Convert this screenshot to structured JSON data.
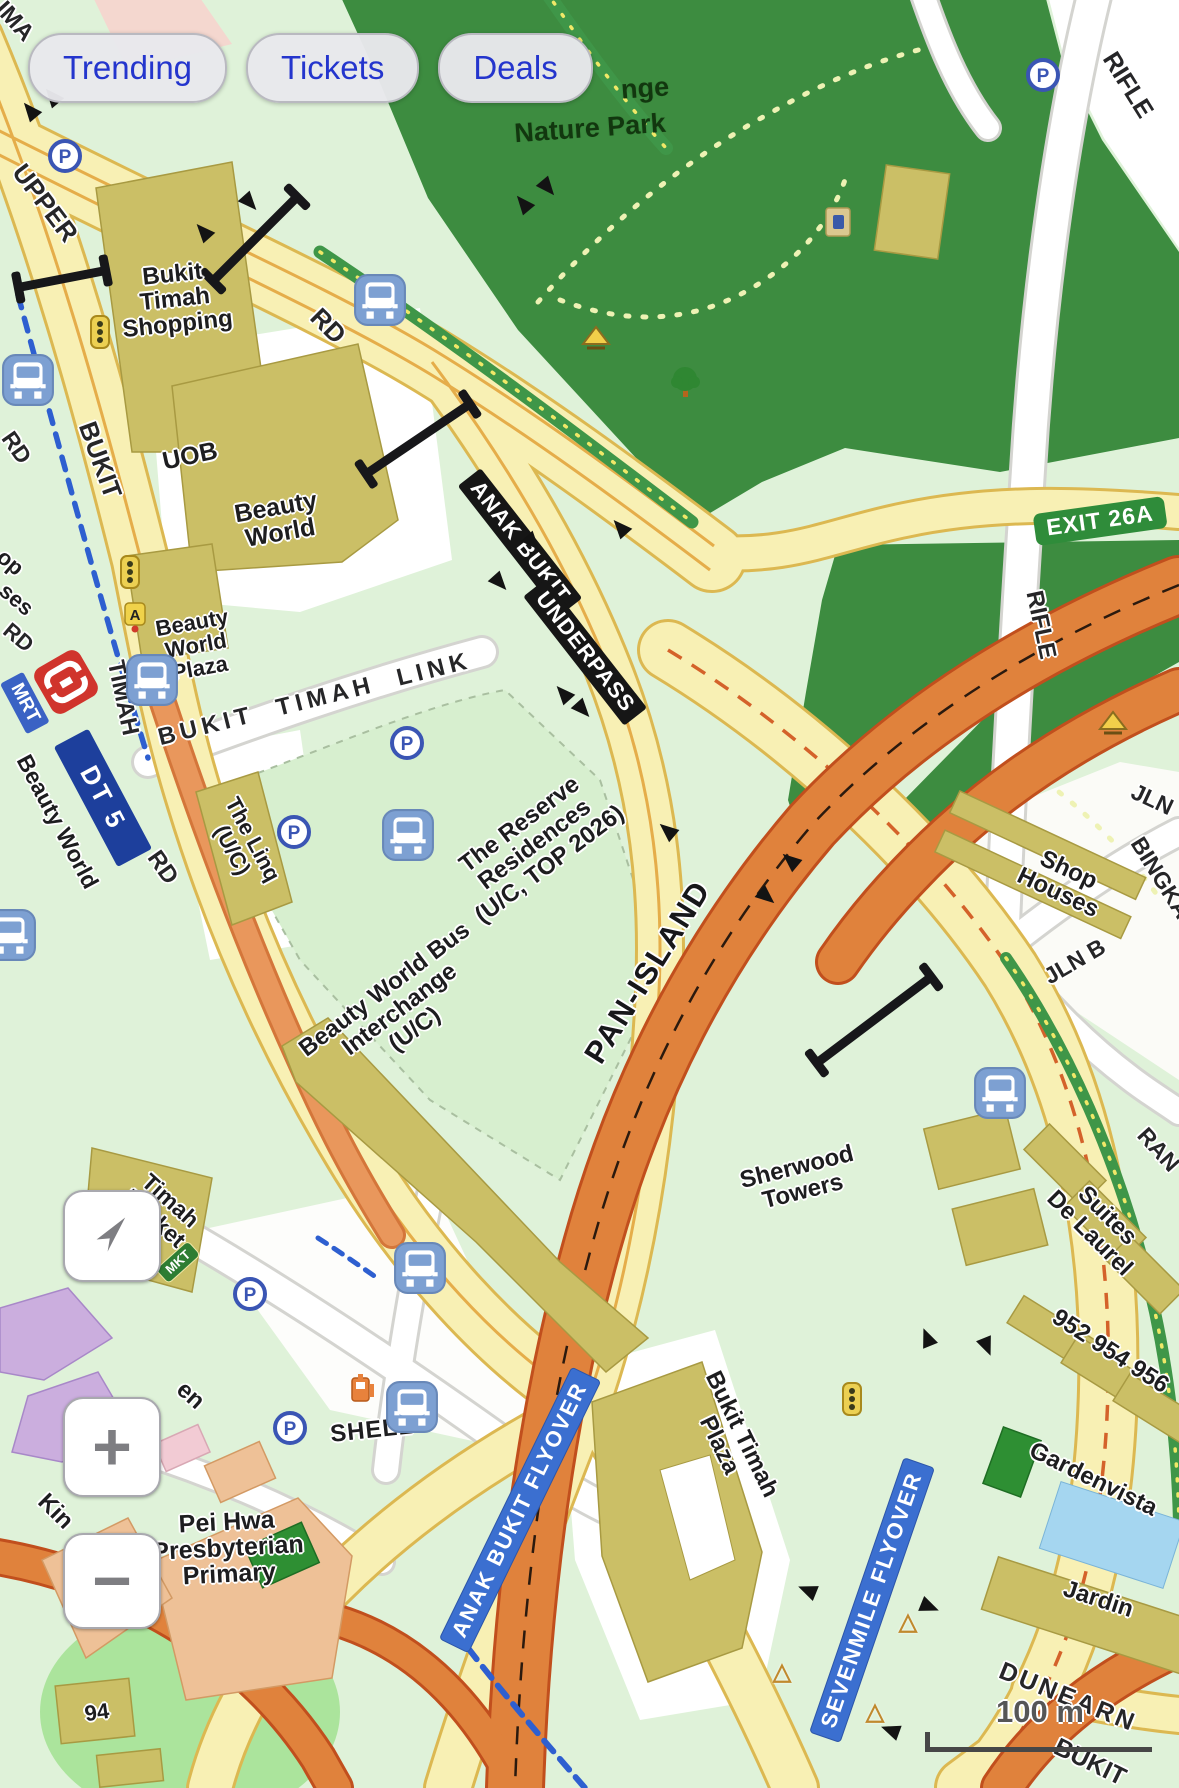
{
  "chips": {
    "items": [
      {
        "label": "Trending"
      },
      {
        "label": "Tickets"
      },
      {
        "label": "Deals"
      }
    ]
  },
  "controls": {
    "zoom_in_label": "+",
    "zoom_out_label": "−"
  },
  "scale_bar": {
    "label": "100 m"
  },
  "mrt": {
    "badge": "MRT",
    "code": "DT 5",
    "station": "Beauty World"
  },
  "colors": {
    "accent_blue": "#2435cd",
    "park_green": "#3d8c40",
    "expressway_orange": "#e0823c",
    "road_yellow": "#f8f0b4",
    "building_olive": "#cbbf66",
    "flyover_badge": "#3b6fd0",
    "mrt_navy": "#1d3f9c",
    "mrt_red": "#d0342c"
  },
  "map": {
    "labels": [
      {
        "t": "IMA",
        "x": 14,
        "y": 22,
        "r": 48,
        "c": "road",
        "s": 24
      },
      {
        "t": "UPPER",
        "x": 45,
        "y": 203,
        "r": 53,
        "c": "road",
        "s": 26
      },
      {
        "t": "BUKIT",
        "x": 100,
        "y": 460,
        "r": 70,
        "c": "road",
        "s": 26
      },
      {
        "t": "RD",
        "x": 16,
        "y": 448,
        "r": 55,
        "c": "road",
        "s": 23
      },
      {
        "t": "op",
        "x": 10,
        "y": 563,
        "r": 40,
        "c": "building",
        "s": 22
      },
      {
        "t": "ses",
        "x": 16,
        "y": 600,
        "r": 40,
        "c": "building",
        "s": 22
      },
      {
        "t": "RD",
        "x": 18,
        "y": 638,
        "r": 40,
        "c": "road",
        "s": 22
      },
      {
        "t": "TIMAH",
        "x": 122,
        "y": 698,
        "r": 78,
        "c": "road",
        "s": 24
      },
      {
        "t": "RD",
        "x": 162,
        "y": 868,
        "r": 55,
        "c": "road",
        "s": 24
      },
      {
        "t": "RD",
        "x": 328,
        "y": 326,
        "r": 45,
        "c": "road",
        "s": 26
      },
      {
        "t": "BUKIT  TIMAH  LINK",
        "x": 315,
        "y": 700,
        "r": -14,
        "c": "road",
        "s": 24,
        "ls": 5
      },
      {
        "t": "Bukit\nTimah\nShopping",
        "x": 175,
        "y": 300,
        "r": -6,
        "c": "building",
        "s": 24
      },
      {
        "t": "UOB",
        "x": 190,
        "y": 456,
        "r": -12,
        "c": "building",
        "s": 25
      },
      {
        "t": "Beauty\nWorld",
        "x": 278,
        "y": 520,
        "r": -10,
        "c": "building",
        "s": 25
      },
      {
        "t": "Beauty\nWorld\nPlaza",
        "x": 196,
        "y": 646,
        "r": -10,
        "c": "building",
        "s": 22
      },
      {
        "t": "The Linq\n(U/C)",
        "x": 242,
        "y": 845,
        "r": 62,
        "c": "building",
        "s": 22
      },
      {
        "t": "ANAK BUKIT",
        "x": 520,
        "y": 542,
        "r": 52,
        "c": "badge-black",
        "s": 22
      },
      {
        "t": "UNDERPASS",
        "x": 585,
        "y": 652,
        "r": 52,
        "c": "badge-black",
        "s": 22
      },
      {
        "t": "nge",
        "x": 645,
        "y": 88,
        "r": -4,
        "c": "park",
        "s": 27
      },
      {
        "t": "Nature Park",
        "x": 590,
        "y": 128,
        "r": -4,
        "c": "park",
        "s": 27
      },
      {
        "t": "RIFLE",
        "x": 1128,
        "y": 85,
        "r": 58,
        "c": "road",
        "s": 25
      },
      {
        "t": "EXIT 26A",
        "x": 1100,
        "y": 521,
        "r": -8,
        "c": "badge-green",
        "s": 23
      },
      {
        "t": "RIFLE",
        "x": 1040,
        "y": 625,
        "r": 78,
        "c": "road",
        "s": 24
      },
      {
        "t": "JLN",
        "x": 1152,
        "y": 800,
        "r": 25,
        "c": "road",
        "s": 23
      },
      {
        "t": "BINGKA",
        "x": 1160,
        "y": 878,
        "r": 58,
        "c": "road",
        "s": 23
      },
      {
        "t": "Shop\nHouses",
        "x": 1063,
        "y": 882,
        "r": 25,
        "c": "building",
        "s": 24
      },
      {
        "t": "JLN B",
        "x": 1075,
        "y": 962,
        "r": -30,
        "c": "road",
        "s": 23
      },
      {
        "t": "The Reserve\nResidences\n(U/C, TOP 2026)",
        "x": 535,
        "y": 845,
        "r": -37,
        "c": "building",
        "s": 24
      },
      {
        "t": "Beauty World Bus\nInterchange\n(U/C)",
        "x": 400,
        "y": 1010,
        "r": -37,
        "c": "building",
        "s": 24
      },
      {
        "t": "PAN-ISLAND",
        "x": 648,
        "y": 972,
        "r": -58,
        "c": "road-big",
        "s": 31
      },
      {
        "t": "RAN",
        "x": 1158,
        "y": 1150,
        "r": 48,
        "c": "road",
        "s": 23
      },
      {
        "t": "Sherwood\nTowers",
        "x": 800,
        "y": 1180,
        "r": -14,
        "c": "building",
        "s": 24
      },
      {
        "t": "Suites\nDe Laurel",
        "x": 1098,
        "y": 1225,
        "r": 45,
        "c": "building",
        "s": 24
      },
      {
        "t": "952 954 956",
        "x": 1110,
        "y": 1352,
        "r": 33,
        "c": "building",
        "s": 24
      },
      {
        "t": "Gardenvista",
        "x": 1093,
        "y": 1480,
        "r": 26,
        "c": "building",
        "s": 24
      },
      {
        "t": "Jardin",
        "x": 1098,
        "y": 1600,
        "r": 18,
        "c": "building",
        "s": 24
      },
      {
        "t": "DUNEARN",
        "x": 1068,
        "y": 1697,
        "r": 22,
        "c": "road",
        "s": 25,
        "ls": 3
      },
      {
        "t": "BUKIT",
        "x": 1090,
        "y": 1762,
        "r": 26,
        "c": "road",
        "s": 25
      },
      {
        "t": "Bukit Timah\nPlaza",
        "x": 730,
        "y": 1440,
        "r": 64,
        "c": "building",
        "s": 24
      },
      {
        "t": "ANAK BUKIT FLYOVER",
        "x": 520,
        "y": 1510,
        "r": -64,
        "c": "badge-blue",
        "s": 22
      },
      {
        "t": "SEVENMILE FLYOVER",
        "x": 872,
        "y": 1600,
        "r": -71,
        "c": "badge-blue",
        "s": 22
      },
      {
        "t": "Pei Hwa\nPresbyterian\nPrimary",
        "x": 228,
        "y": 1548,
        "r": -3,
        "c": "building",
        "s": 25
      },
      {
        "t": "SHELL",
        "x": 372,
        "y": 1431,
        "r": -6,
        "c": "building",
        "s": 24,
        "ls": 1
      },
      {
        "t": "Kin",
        "x": 55,
        "y": 1512,
        "r": 45,
        "c": "building",
        "s": 24
      },
      {
        "t": "en",
        "x": 190,
        "y": 1396,
        "r": 42,
        "c": "building",
        "s": 24
      },
      {
        "t": "Timah\nMarket",
        "x": 162,
        "y": 1210,
        "r": 42,
        "c": "building",
        "s": 23
      },
      {
        "t": "MKT",
        "x": 178,
        "y": 1262,
        "r": -42,
        "c": "badge-mkt",
        "s": 13
      },
      {
        "t": "94",
        "x": 97,
        "y": 1713,
        "r": -8,
        "c": "building",
        "s": 22
      },
      {
        "t": "Beauty World",
        "x": 57,
        "y": 822,
        "r": 62,
        "c": "building",
        "s": 23
      },
      {
        "t": "DT 5",
        "x": 103,
        "y": 798,
        "r": 62,
        "c": "badge-navy",
        "s": 26
      },
      {
        "t": "MRT",
        "x": 25,
        "y": 703,
        "r": 62,
        "c": "badge-mrtblue",
        "s": 19
      }
    ],
    "icons": [
      {
        "k": "bus",
        "x": 380,
        "y": 300
      },
      {
        "k": "bus",
        "x": 28,
        "y": 380
      },
      {
        "k": "bus",
        "x": 152,
        "y": 680
      },
      {
        "k": "bus",
        "x": 408,
        "y": 835
      },
      {
        "k": "bus",
        "x": 10,
        "y": 935
      },
      {
        "k": "bus",
        "x": 1000,
        "y": 1093
      },
      {
        "k": "bus",
        "x": 420,
        "y": 1268
      },
      {
        "k": "bus",
        "x": 412,
        "y": 1407
      },
      {
        "k": "parking",
        "x": 65,
        "y": 156
      },
      {
        "k": "parking",
        "x": 1043,
        "y": 75
      },
      {
        "k": "parking",
        "x": 407,
        "y": 743
      },
      {
        "k": "parking",
        "x": 294,
        "y": 832
      },
      {
        "k": "parking",
        "x": 250,
        "y": 1294
      },
      {
        "k": "parking",
        "x": 290,
        "y": 1428
      },
      {
        "k": "traffic-light",
        "x": 100,
        "y": 332
      },
      {
        "k": "traffic-light",
        "x": 130,
        "y": 572
      },
      {
        "k": "traffic-light",
        "x": 852,
        "y": 1399
      },
      {
        "k": "a-badge",
        "x": 135,
        "y": 617
      },
      {
        "k": "fuel",
        "x": 362,
        "y": 1388
      },
      {
        "k": "tree",
        "x": 685,
        "y": 382
      },
      {
        "k": "shelter",
        "x": 596,
        "y": 338
      },
      {
        "k": "shelter",
        "x": 1113,
        "y": 723
      },
      {
        "k": "hut",
        "x": 838,
        "y": 222
      },
      {
        "k": "mrt-logo",
        "x": 66,
        "y": 682,
        "r": -30
      }
    ],
    "arrows": [
      [
        30,
        110,
        -40
      ],
      [
        52,
        96,
        -40
      ],
      [
        203,
        231,
        -42
      ],
      [
        250,
        203,
        138
      ],
      [
        523,
        203,
        -40
      ],
      [
        548,
        188,
        140
      ],
      [
        533,
        543,
        138
      ],
      [
        620,
        527,
        -42
      ],
      [
        500,
        583,
        138
      ],
      [
        563,
        693,
        -42
      ],
      [
        583,
        710,
        138
      ],
      [
        790,
        860,
        -50
      ],
      [
        767,
        897,
        130
      ],
      [
        667,
        830,
        -50
      ],
      [
        927,
        1337,
        -22
      ],
      [
        987,
        1347,
        158
      ],
      [
        807,
        1590,
        -68
      ],
      [
        930,
        1607,
        112
      ],
      [
        890,
        1730,
        -70
      ]
    ],
    "yields": [
      [
        908,
        1622
      ],
      [
        875,
        1712
      ],
      [
        782,
        1672
      ]
    ],
    "gantries": [
      [
        62,
        279,
        90,
        -11
      ],
      [
        255,
        239,
        120,
        -45
      ],
      [
        418,
        439,
        126,
        -34
      ],
      [
        874,
        1020,
        144,
        -37
      ]
    ]
  }
}
